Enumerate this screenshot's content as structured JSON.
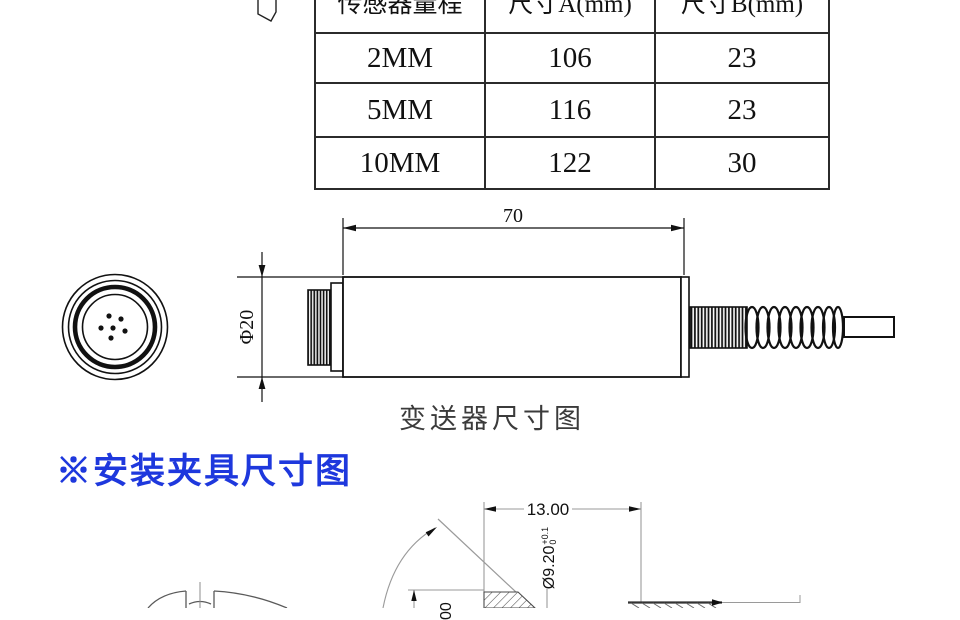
{
  "table": {
    "headers": [
      "传感器量程",
      "尺寸A(mm)",
      "尺寸B(mm)"
    ],
    "rows": [
      [
        "2MM",
        "106",
        "23"
      ],
      [
        "5MM",
        "116",
        "23"
      ],
      [
        "10MM",
        "122",
        "30"
      ]
    ]
  },
  "transmitter": {
    "dim_length": "70",
    "dim_diameter": "Φ20",
    "caption": "变送器尺寸图"
  },
  "fixture": {
    "heading": "※安装夹具尺寸图",
    "dim_width": "13.00",
    "dim_bore": "Ø9.20",
    "dim_bore_tol_upper": "+0.1",
    "dim_bore_tol_lower": "0",
    "dim_partial": "00"
  },
  "colors": {
    "accent_blue": "#1e38dd",
    "caption_gray": "#3b3b3b",
    "drawing_black": "#111111",
    "drawing_gray": "#8c8c8c"
  }
}
